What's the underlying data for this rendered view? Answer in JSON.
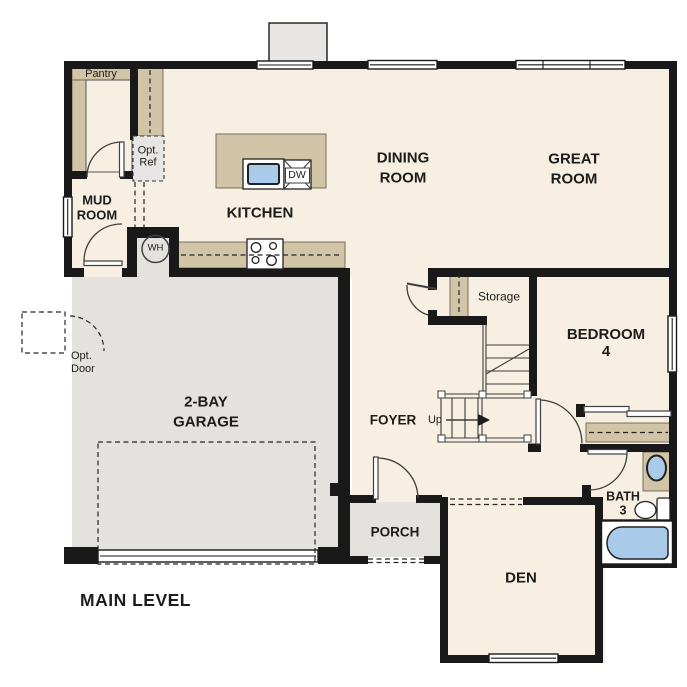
{
  "title": "MAIN LEVEL",
  "palette": {
    "floor": "#f7efe1",
    "concrete": "#e3e2df",
    "cabinet": "#d2c4a6",
    "wall": "#191919",
    "water": "#a9cbe9",
    "ink": "#1c1c1c"
  },
  "rooms": {
    "pantry": "Pantry",
    "mud_room": "MUD\nROOM",
    "kitchen": "KITCHEN",
    "dining_room": "DINING\nROOM",
    "great_room": "GREAT\nROOM",
    "storage": "Storage",
    "bedroom_4": "BEDROOM 4",
    "foyer": "FOYER",
    "garage": "2-BAY\nGARAGE",
    "porch": "PORCH",
    "den": "DEN",
    "bath_3": "BATH\n3"
  },
  "annotations": {
    "opt_ref": "Opt.\nRef",
    "opt_door": "Opt.\nDoor",
    "up": "Up",
    "water_heater": "WH",
    "dishwasher": "DW",
    "level": "MAIN LEVEL"
  }
}
